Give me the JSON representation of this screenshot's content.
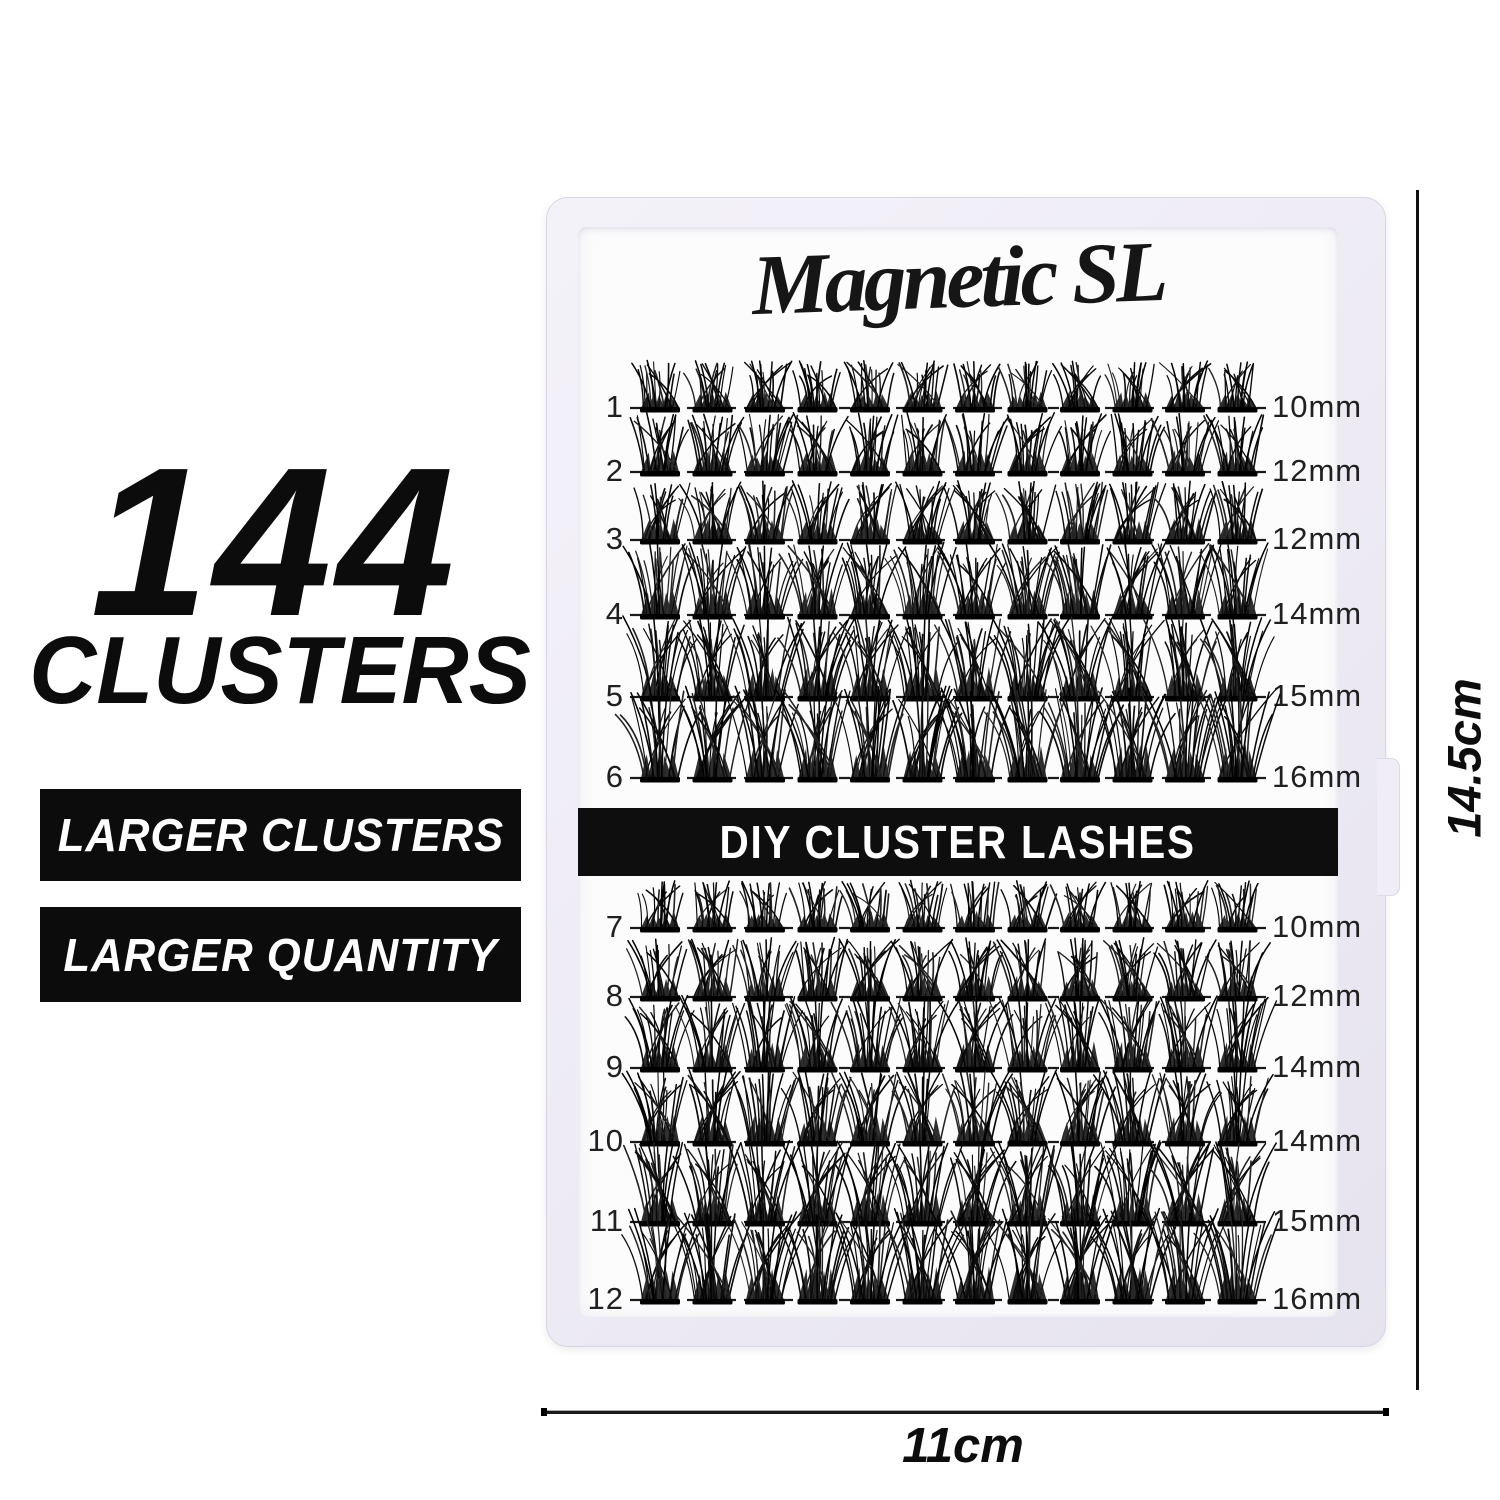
{
  "promo": {
    "headline_count": "144",
    "headline_label": "CLUSTERS",
    "badges": [
      {
        "label": "LARGER CLUSTERS"
      },
      {
        "label": "LARGER QUANTITY"
      }
    ]
  },
  "tray": {
    "brand": "Magnetic SL",
    "banner_label": "DIY CLUSTER LASHES",
    "clusters_per_row": 12,
    "rows": [
      {
        "number": "1",
        "length": "10mm"
      },
      {
        "number": "2",
        "length": "12mm"
      },
      {
        "number": "3",
        "length": "12mm"
      },
      {
        "number": "4",
        "length": "14mm"
      },
      {
        "number": "5",
        "length": "15mm"
      },
      {
        "number": "6",
        "length": "16mm"
      },
      {
        "number": "7",
        "length": "10mm"
      },
      {
        "number": "8",
        "length": "12mm"
      },
      {
        "number": "9",
        "length": "14mm"
      },
      {
        "number": "10",
        "length": "14mm"
      },
      {
        "number": "11",
        "length": "15mm"
      },
      {
        "number": "12",
        "length": "16mm"
      }
    ]
  },
  "measurements": {
    "tray_height": "14.5cm",
    "tray_width": "11cm"
  },
  "colors": {
    "badge_bg": "#0c0c0c",
    "banner_bg": "#0e0e0e",
    "lash": "#0b0b0b",
    "tray_frame": "#ece9f3",
    "text": "#0d0d0d"
  }
}
